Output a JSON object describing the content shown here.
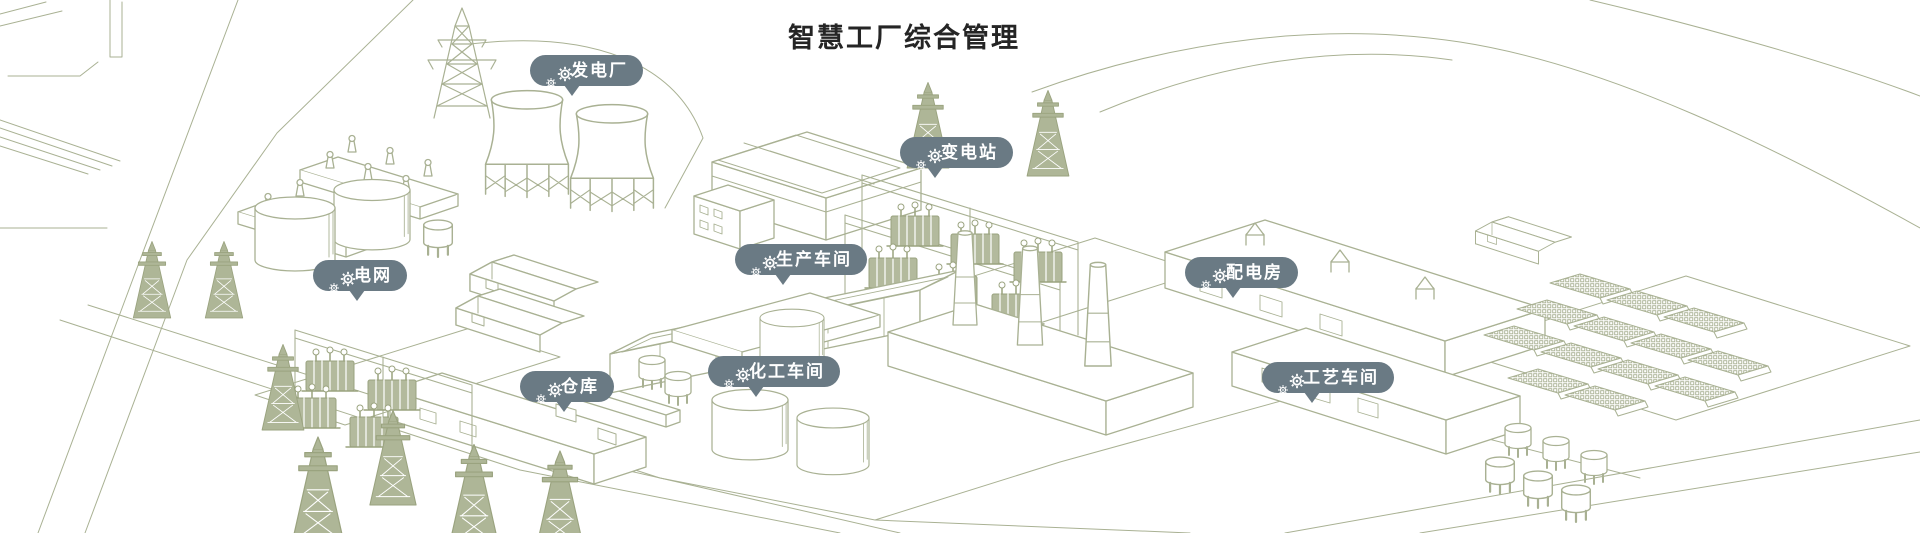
{
  "page_title": "智慧工厂综合管理",
  "colors": {
    "badge_background": "#6a7a84",
    "badge_text": "#ffffff",
    "line_art_sage": "#a9b193",
    "background": "#ffffff",
    "title_text": "#252525"
  },
  "markers": [
    {
      "id": "power-plant",
      "label": "发电厂",
      "icon": "gears-icon"
    },
    {
      "id": "substation",
      "label": "变电站",
      "icon": "gears-icon"
    },
    {
      "id": "power-grid",
      "label": "电网",
      "icon": "gears-icon"
    },
    {
      "id": "production-workshop",
      "label": "生产车间",
      "icon": "gears-icon"
    },
    {
      "id": "power-distribution-room",
      "label": "配电房",
      "icon": "gears-icon"
    },
    {
      "id": "warehouse",
      "label": "仓库",
      "icon": "gears-icon"
    },
    {
      "id": "chemical-workshop",
      "label": "化工车间",
      "icon": "gears-icon"
    },
    {
      "id": "process-workshop",
      "label": "工艺车间",
      "icon": "gears-icon"
    }
  ]
}
